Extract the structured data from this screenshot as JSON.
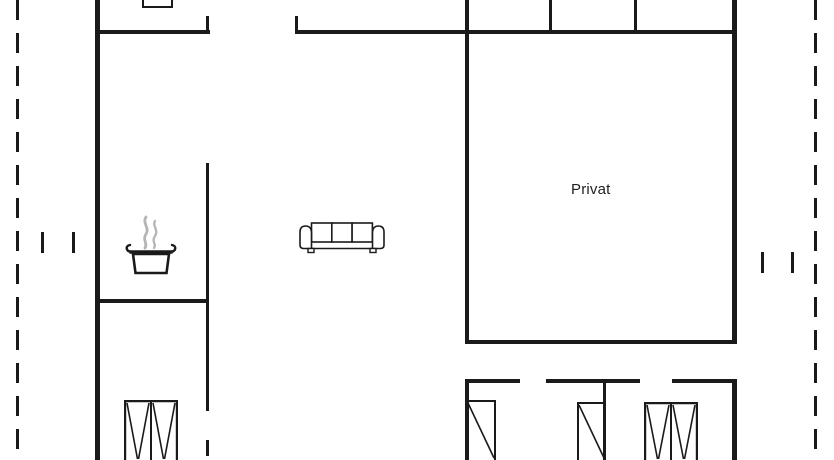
{
  "floor_plan": {
    "room_label": "Privat",
    "colors": {
      "wall": "#1a1a1a",
      "background": "#ffffff",
      "steam": "#b5b5b5"
    },
    "icons": [
      {
        "name": "cooking-pot-icon",
        "meaning": "kitchen / stove area"
      },
      {
        "name": "sofa-icon",
        "meaning": "living room seating"
      },
      {
        "name": "wardrobe-double-icon",
        "meaning": "double wardrobe"
      },
      {
        "name": "wardrobe-single-icon",
        "meaning": "single wardrobe"
      }
    ]
  }
}
